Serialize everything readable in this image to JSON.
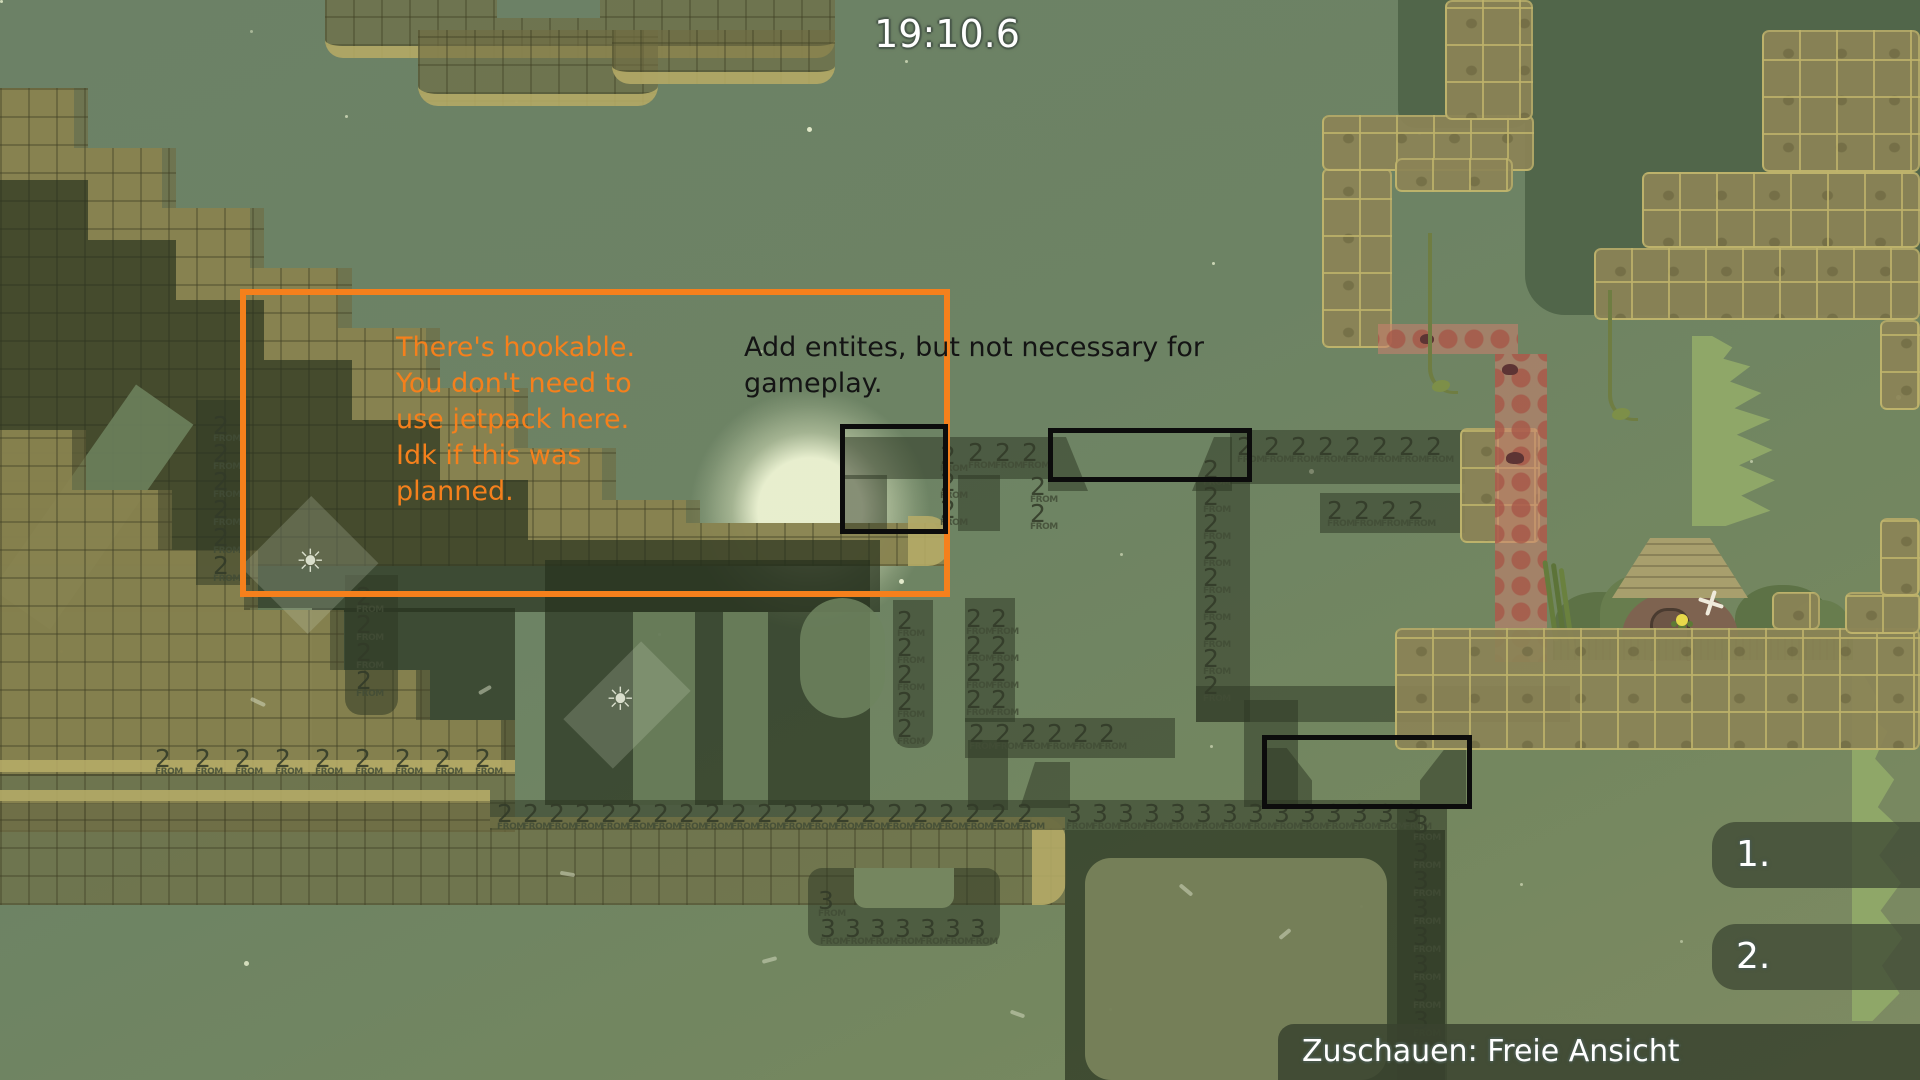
{
  "hud": {
    "timer": "19:10.6",
    "marker1": "1.",
    "marker2": "2.",
    "spectate_label": "Zuschauen: Freie Ansicht"
  },
  "annotations": {
    "orange_note": "There's hookable.\nYou don't need to\nuse jetpack here.\nIdk if this was\nplanned.",
    "black_note": "Add entites, but not necessary for\ngameplay.",
    "orange_color": "#f5801c",
    "black_color": "#0c0c0c"
  },
  "tele_labels": {
    "from_text": "FROM",
    "groups": [
      {
        "n": "2",
        "x": 155,
        "y": 746,
        "count": 9,
        "dx": 40,
        "dy": 0
      },
      {
        "n": "2",
        "x": 497,
        "y": 801,
        "count": 21,
        "dx": 26,
        "dy": 0
      },
      {
        "n": "3",
        "x": 1066,
        "y": 801,
        "count": 14,
        "dx": 26,
        "dy": 0
      },
      {
        "n": "2",
        "x": 968,
        "y": 440,
        "count": 3,
        "dx": 27,
        "dy": 0
      },
      {
        "n": "2",
        "x": 940,
        "y": 443,
        "count": 3,
        "dx": 0,
        "dy": 27
      },
      {
        "n": "2",
        "x": 1237,
        "y": 434,
        "count": 8,
        "dx": 27,
        "dy": 0
      },
      {
        "n": "2",
        "x": 1327,
        "y": 498,
        "count": 4,
        "dx": 27,
        "dy": 0
      },
      {
        "n": "2",
        "x": 969,
        "y": 721,
        "count": 6,
        "dx": 26,
        "dy": 0
      },
      {
        "n": "3",
        "x": 820,
        "y": 916,
        "count": 7,
        "dx": 25,
        "dy": 0
      },
      {
        "n": "3",
        "x": 818,
        "y": 888,
        "count": 1,
        "dx": 0,
        "dy": 0
      },
      {
        "n": "2",
        "x": 213,
        "y": 413,
        "count": 6,
        "dx": 0,
        "dy": 28
      },
      {
        "n": "2",
        "x": 356,
        "y": 584,
        "count": 4,
        "dx": 0,
        "dy": 28
      },
      {
        "n": "2",
        "x": 1203,
        "y": 457,
        "count": 9,
        "dx": 0,
        "dy": 27
      },
      {
        "n": "2",
        "x": 897,
        "y": 608,
        "count": 5,
        "dx": 0,
        "dy": 27
      },
      {
        "n": "2",
        "x": 966,
        "y": 606,
        "count": 4,
        "dx": 0,
        "dy": 27
      },
      {
        "n": "2",
        "x": 991,
        "y": 606,
        "count": 4,
        "dx": 0,
        "dy": 27
      },
      {
        "n": "3",
        "x": 1413,
        "y": 812,
        "count": 8,
        "dx": 0,
        "dy": 28
      },
      {
        "n": "2",
        "x": 1030,
        "y": 474,
        "count": 2,
        "dx": 0,
        "dy": 27
      }
    ]
  },
  "scene": {
    "background_top": "#6c8166",
    "background_bottom": "#7e8a62",
    "corridor_color": "rgba(46,56,36,0.52)",
    "grass_color": "#b6ac68",
    "stone_color": "#8b8356",
    "icons": [
      "sun-icon",
      "bone-icon",
      "bat-icon"
    ]
  }
}
